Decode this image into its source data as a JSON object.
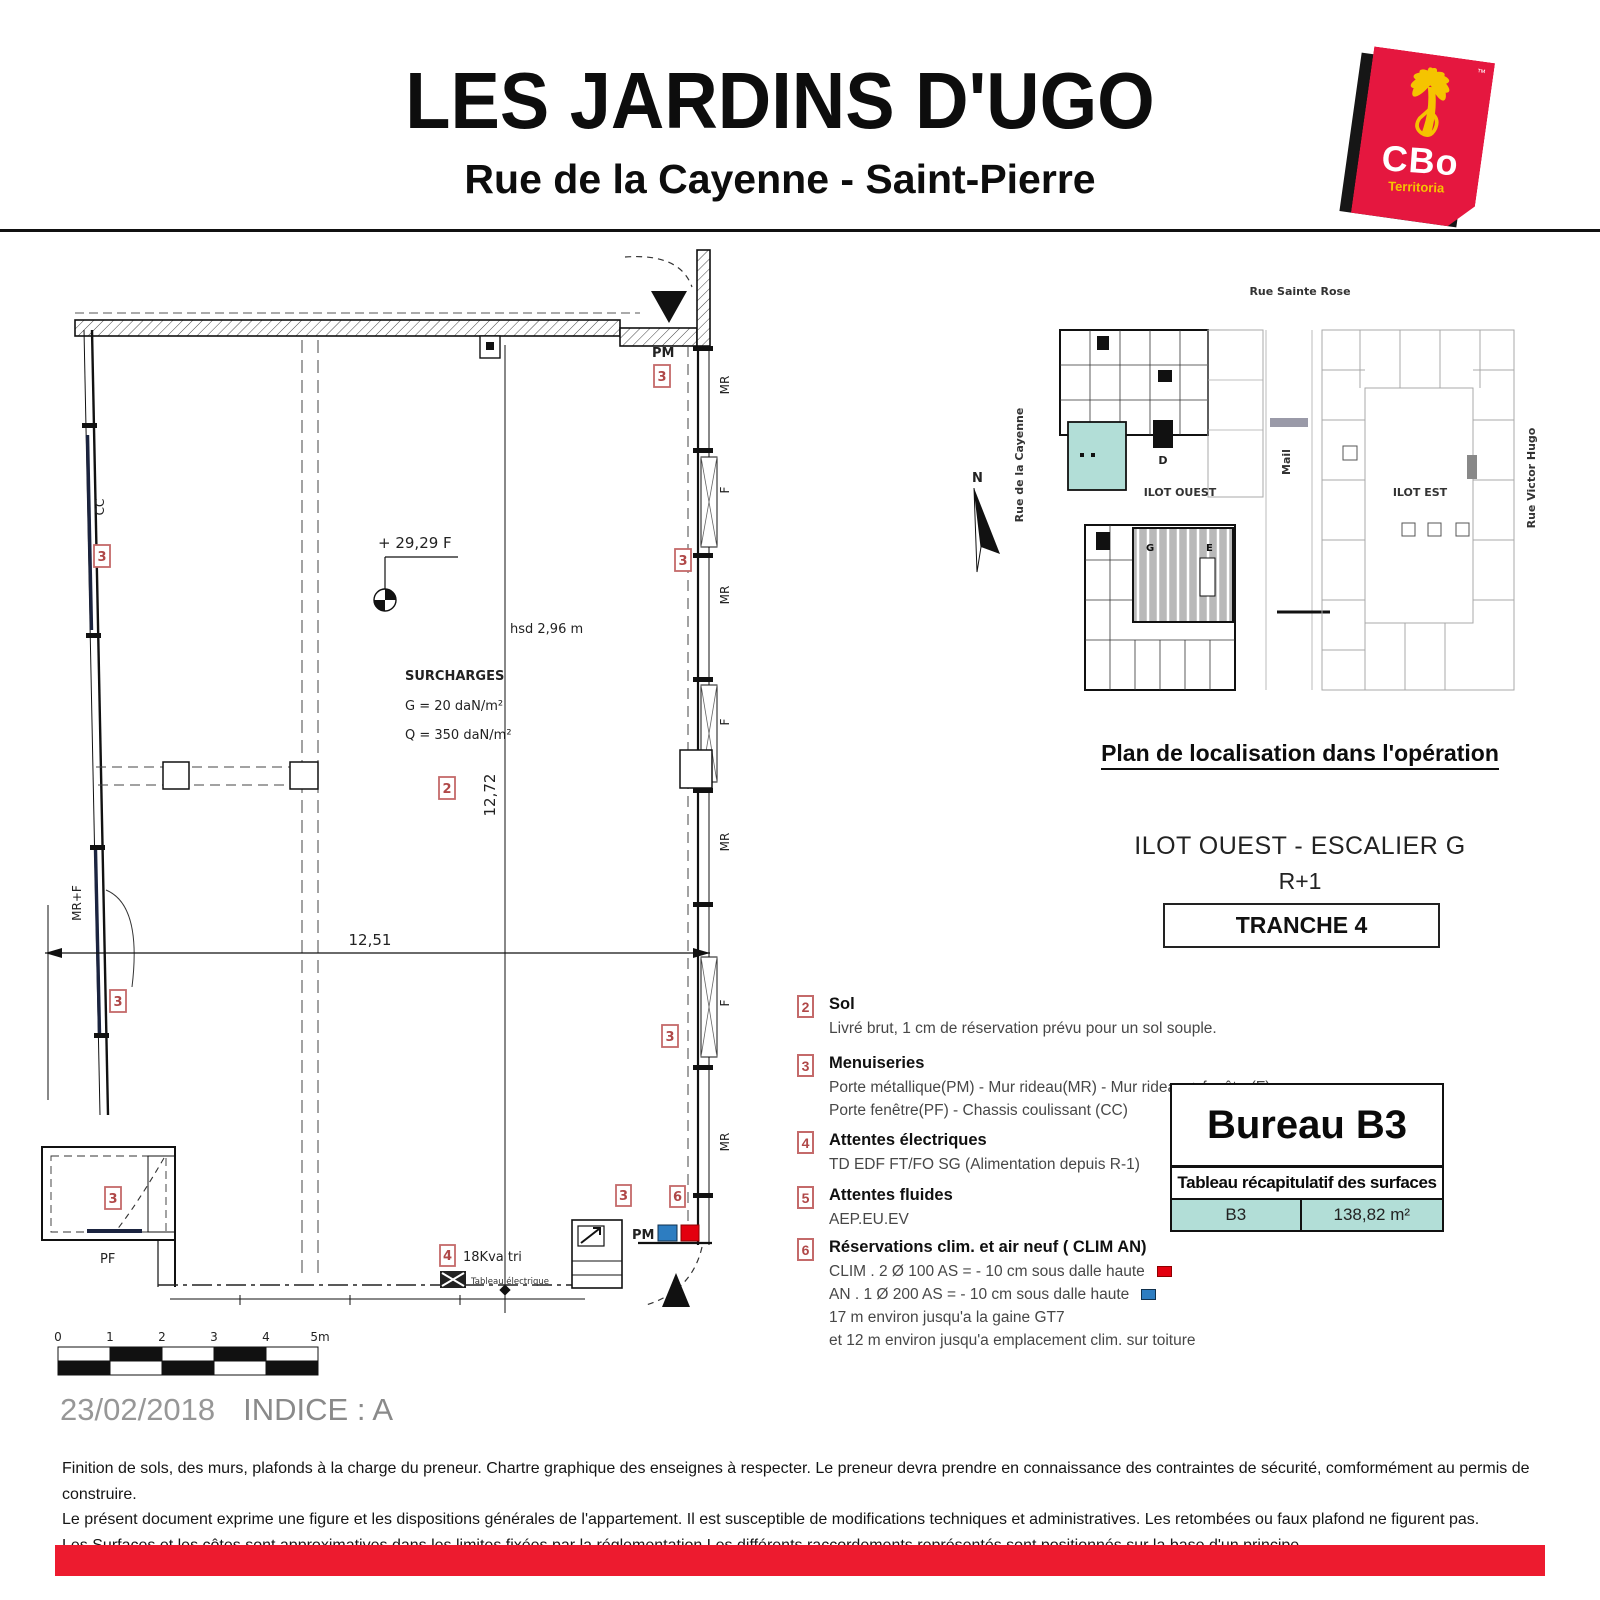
{
  "header": {
    "title": "LES JARDINS D'UGO",
    "subtitle": "Rue de la Cayenne - Saint-Pierre"
  },
  "logo": {
    "name": "CBo",
    "sub": "Territoria",
    "tm": "™"
  },
  "plan": {
    "level": "+ 29,29 F",
    "hsd": "hsd 2,96 m",
    "surcharges_title": "SURCHARGES",
    "surcharges_g": "G = 20 daN/m²",
    "surcharges_q": "Q = 350 daN/m²",
    "dim_width": "12,51",
    "dim_height": "12,72",
    "pm_top": "PM",
    "pm_bottom": "PM",
    "cc": "CC",
    "mrf": "MR+F",
    "pf": "PF",
    "kva": "18Kva tri",
    "tableau_elec": "Tableau électrique",
    "right_labels": [
      "MR",
      "F",
      "MR",
      "F",
      "MR",
      "F",
      "MR"
    ],
    "markers": {
      "m2": "2",
      "m3": "3",
      "m4": "4",
      "m6": "6"
    },
    "scale_ticks": [
      "0",
      "1",
      "2",
      "3",
      "4",
      "5m"
    ]
  },
  "location": {
    "rue_top": "Rue Sainte Rose",
    "rue_left": "Rue de la Cayenne",
    "mail": "Mail",
    "rue_right": "Rue Victor Hugo",
    "ilot_ouest": "ILOT OUEST",
    "ilot_est": "ILOT EST",
    "bldg_d": "D",
    "bldg_g": "G",
    "bldg_e": "E",
    "north": "N",
    "caption": "Plan de localisation dans l'opération"
  },
  "info": {
    "escalier": "ILOT OUEST - ESCALIER G",
    "niveau": "R+1",
    "tranche": "TRANCHE 4"
  },
  "legend": {
    "items": [
      {
        "num": "2",
        "title": "Sol",
        "lines": [
          "Livré brut, 1 cm de réservation prévu pour un sol souple."
        ]
      },
      {
        "num": "3",
        "title": "Menuiseries",
        "lines": [
          "Porte métallique(PM) - Mur rideau(MR) - Mur rideau + fenêtre(F)",
          "Porte fenêtre(PF) - Chassis coulissant (CC)"
        ]
      },
      {
        "num": "4",
        "title": "Attentes électriques",
        "lines": [
          "TD EDF FT/FO SG (Alimentation depuis R-1)"
        ]
      },
      {
        "num": "5",
        "title": "Attentes fluides",
        "lines": [
          "AEP.EU.EV"
        ]
      },
      {
        "num": "6",
        "title": "Réservations clim. et air neuf ( CLIM AN)",
        "clim_line": "CLIM . 2 Ø 100 AS = - 10 cm sous dalle haute",
        "an_line": "AN . 1 Ø 200 AS = - 10 cm sous dalle haute",
        "note1": "17 m environ jusqu'a la gaine GT7",
        "note2": "et 12 m environ jusqu'a emplacement clim. sur toiture"
      }
    ]
  },
  "surface_table": {
    "title": "Bureau B3",
    "header": "Tableau récapitulatif des surfaces",
    "unit": "B3",
    "area": "138,82 m²"
  },
  "footer": {
    "date": "23/02/2018",
    "indice": "INDICE : A",
    "lines": [
      "Finition de sols, des murs, plafonds à la charge du preneur. Chartre graphique des enseignes à respecter. Le preneur devra prendre en connaissance des contraintes de sécurité, comformément au permis de construire.",
      "Le présent document exprime une figure et les dispositions générales de l'appartement. Il est susceptible de modifications techniques et administratives. Les retombées ou faux plafond ne figurent pas.",
      "Les Surfaces et les côtes sont approximatives dans les limites fixées par la réglementation.Les différents raccordements représentés sont positionnés sur la base d'un principe."
    ]
  },
  "colors": {
    "accent_red": "#ed1b2f",
    "logo_red": "#e5173f",
    "teal": "#b2ded7",
    "marker": "#b04848",
    "clim_red": "#e3000f",
    "an_blue": "#2d7dc1"
  }
}
